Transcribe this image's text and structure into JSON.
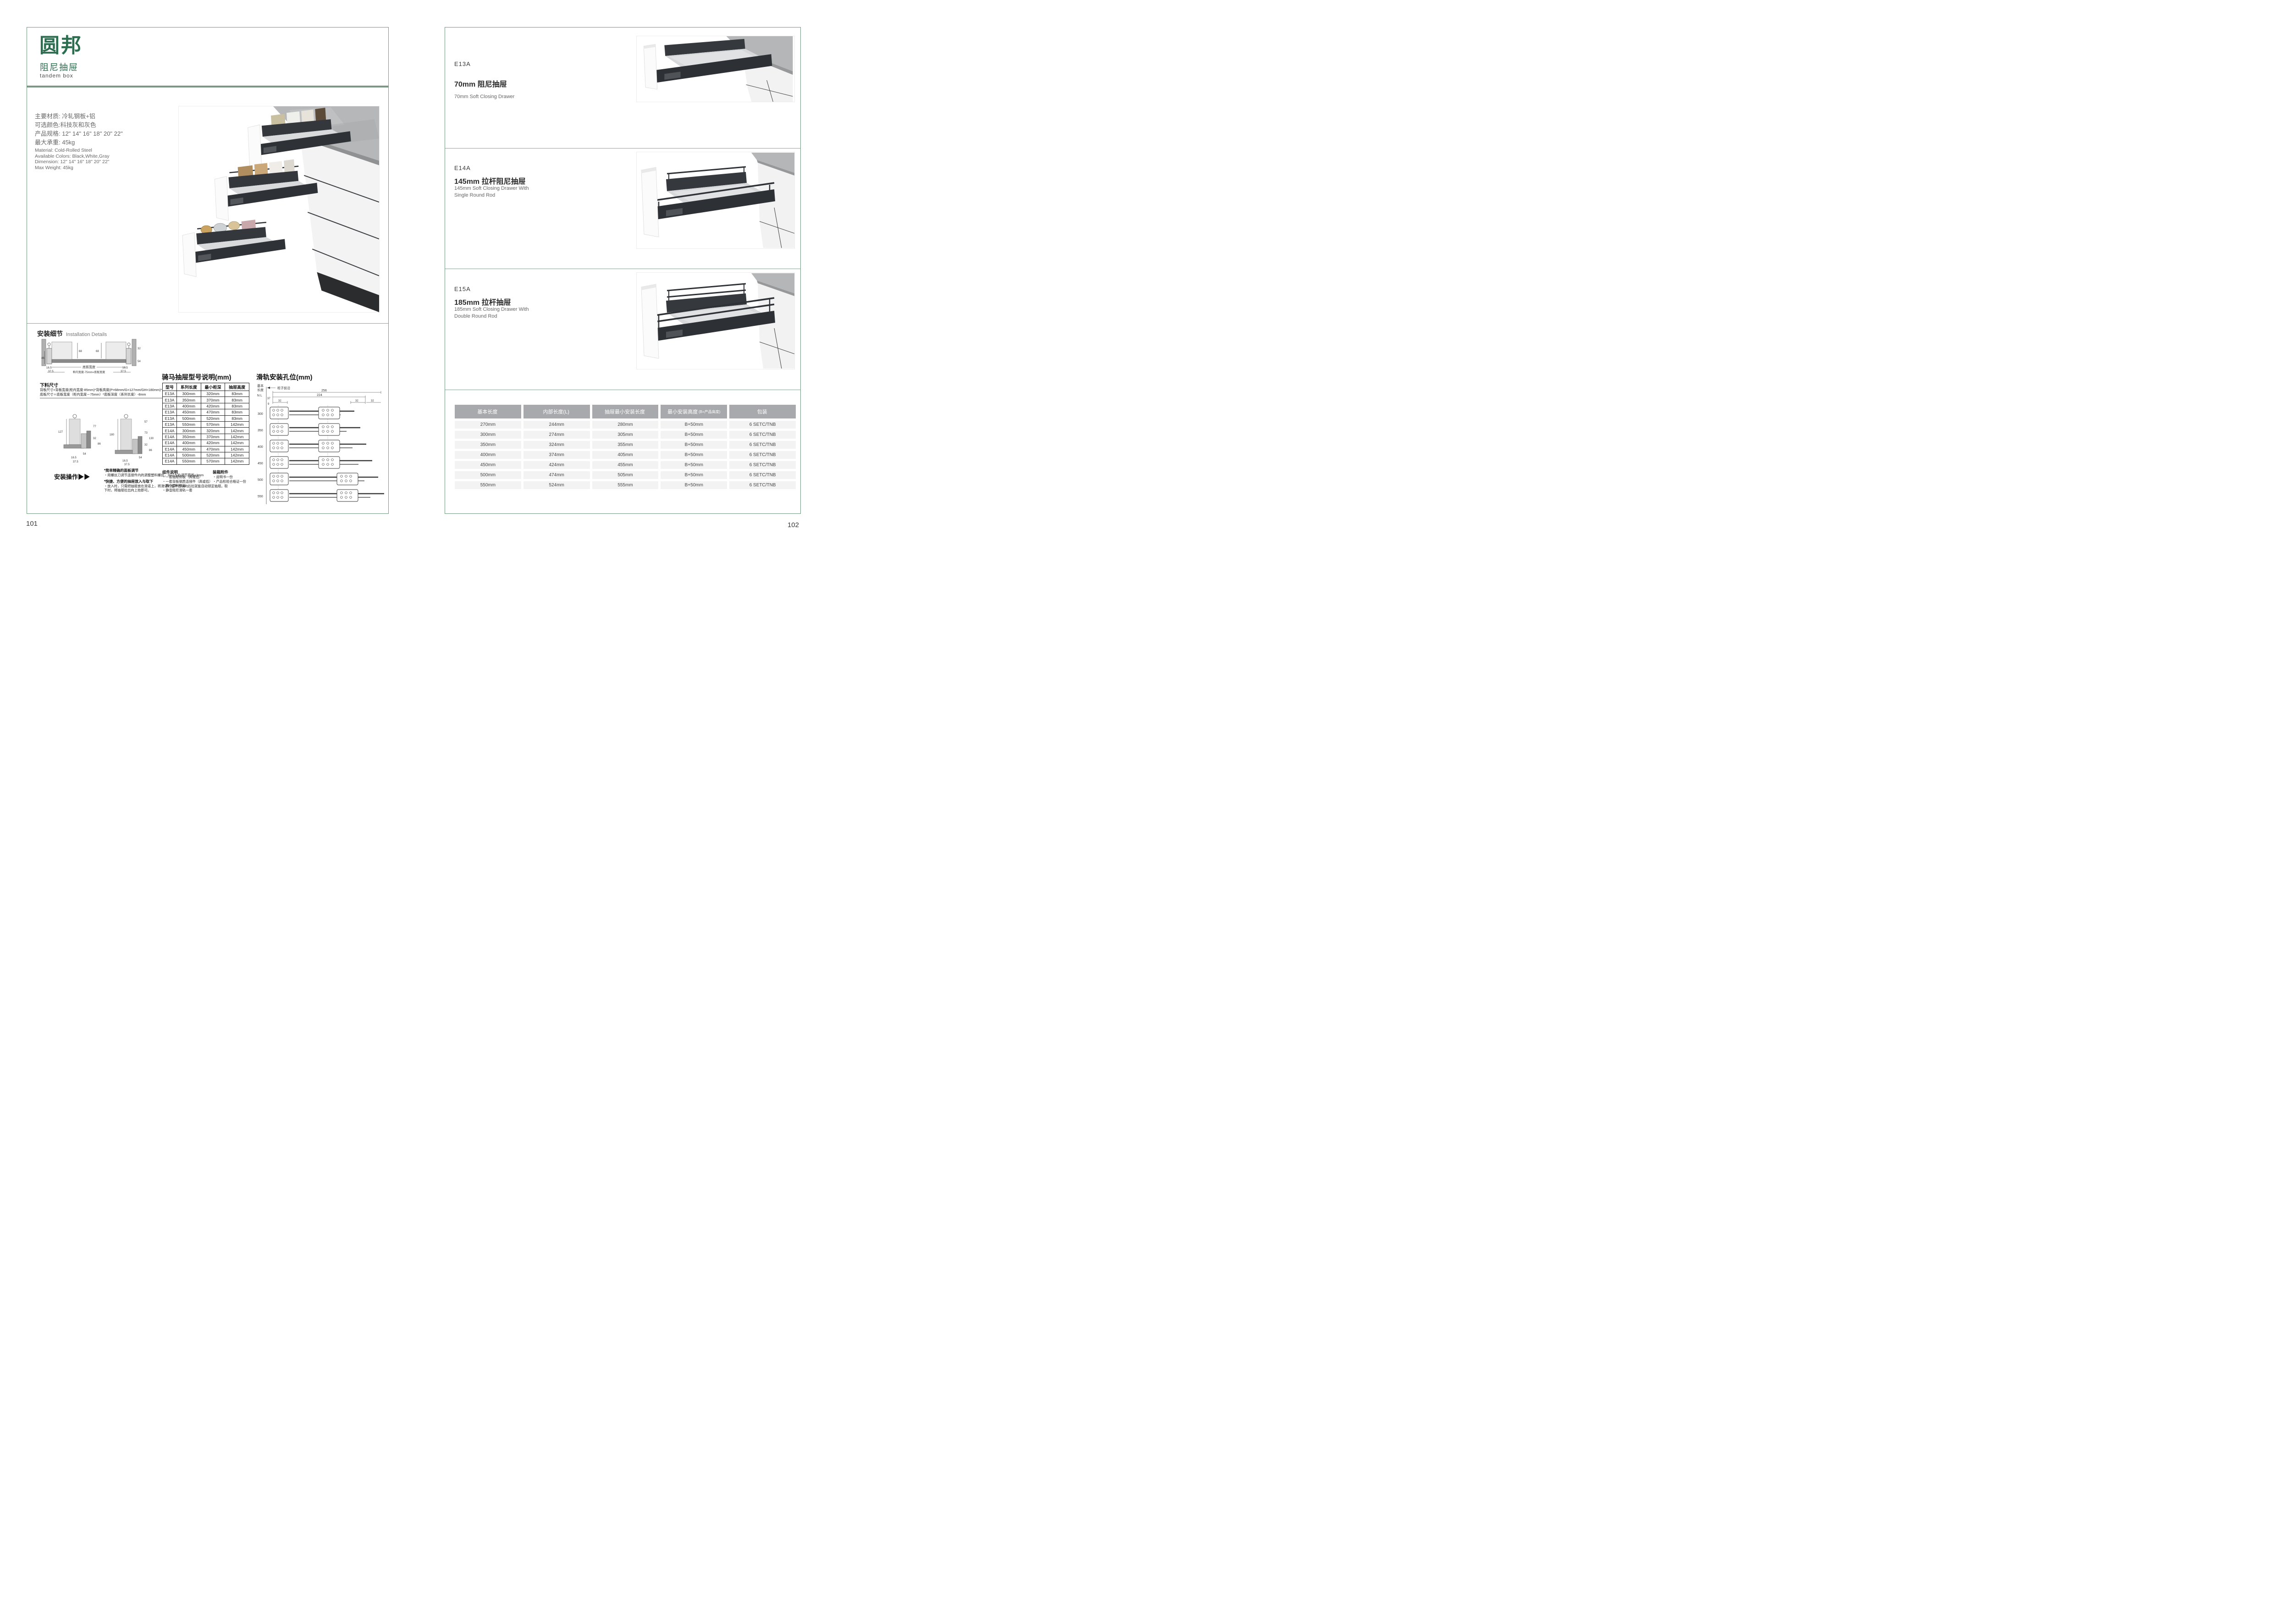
{
  "colors": {
    "brand_green": "#2c6e4f",
    "border_green": "#71977f",
    "divider_green": "#8ca396",
    "table_header_gray": "#a7a9ac",
    "table_row_gray": "#f3f3f4"
  },
  "left_page": {
    "page_number": "101",
    "brand": {
      "logo": "圆邦",
      "subtitle": "阻尼抽屉",
      "tagline": "tandem box"
    },
    "specs_cn": [
      "主要材质: 冷轧钢板+铝",
      "可选颜色:科技灰和灰色",
      "产品规格: 12\" 14\" 16\" 18\" 20\" 22\"",
      "最大承重: 45kg"
    ],
    "specs_en": [
      "Material: Cold-Rolled Steel",
      "Available Colors: Black,White,Gray",
      "Dimension: 12\" 14\" 16\" 18\" 20\" 22\"",
      "Max Weight: 45kg"
    ],
    "install": {
      "title_cn": "安装细节",
      "title_en": "Installation Details",
      "xsec": {
        "d68a": "68",
        "d68b": "68",
        "d46": "46",
        "d32": "32",
        "d54": "54",
        "i165l": "16.5",
        "i375l": "37.5",
        "i165r": "16.5",
        "i375r": "37.5",
        "bw": "底板宽度",
        "fm": "柜内宽度-75mm=底板宽度"
      },
      "cutting": {
        "title": "下料尺寸",
        "line1": "背板尺寸=背板宽度(柜内宽度-85mm)*背板高度(P=68mm/G=127mm/GH=180mm)*16mm",
        "line2": "底板尺寸＝底板宽度（柜内宽度－75mm）*底板深度（系列长度）-8mm"
      },
      "subL": {
        "a": "127",
        "b": "77",
        "c": "32",
        "d": "54",
        "e": "86",
        "f": "16.5",
        "g": "37.5"
      },
      "subR": {
        "a": "180",
        "b": "57",
        "c": "73",
        "d": "130",
        "e": "32",
        "f": "86",
        "g": "54",
        "h": "16.5",
        "i": "37.5"
      },
      "operation": "安装操作▶▶",
      "notes": [
        {
          "head": "*简单精确的面板调节",
          "body": "・用螺丝刀调节连接件内的调整塑料螺丝，可以左右调节面板±3mm"
        },
        {
          "head": "*快捷、方便的抽屉放入与取下",
          "body": "・放入时，只需把抽屉放在滑道上，将滑道的缓冲挡块向后拉就能自动锁定抽屉。取下时，将抽屉拉出向上抬即可。"
        }
      ]
    },
    "model_table": {
      "title": "骑马抽屉型号说明(mm)",
      "headers": [
        "型号",
        "系列长度",
        "最小柜深",
        "抽屉高度"
      ],
      "rows": [
        [
          "E13A",
          "300mm",
          "320mm",
          "83mm"
        ],
        [
          "E13A",
          "350mm",
          "370mm",
          "83mm"
        ],
        [
          "E13A",
          "400mm",
          "420mm",
          "83mm"
        ],
        [
          "E13A",
          "450mm",
          "470mm",
          "83mm"
        ],
        [
          "E13A",
          "500mm",
          "520mm",
          "83mm"
        ],
        [
          "E13A",
          "550mm",
          "570mm",
          "142mm"
        ],
        [
          "E14A",
          "300mm",
          "320mm",
          "142mm"
        ],
        [
          "E14A",
          "350mm",
          "370mm",
          "142mm"
        ],
        [
          "E14A",
          "400mm",
          "420mm",
          "142mm"
        ],
        [
          "E14A",
          "450mm",
          "470mm",
          "142mm"
        ],
        [
          "E14A",
          "500mm",
          "520mm",
          "142mm"
        ],
        [
          "E14A",
          "550mm",
          "570mm",
          "142mm"
        ]
      ]
    },
    "components": {
      "title": "组件说明",
      "items": [
        "・一套抽屉侧板（高或低）",
        "・一套背板钢质连接件（高或低）",
        "・两个塑料侧盖",
        "・静音阻尼滑轨一套"
      ]
    },
    "packing": {
      "title": "装箱附件",
      "items": [
        "・说明书一份",
        "・产品检验合格证一份"
      ]
    },
    "rail": {
      "title": "滑轨安装孔位(mm)",
      "basic1": "基本",
      "basic2": "长度",
      "nl": "N L",
      "front": "柜子前沿",
      "d256": "256",
      "d224": "224",
      "d37": "37",
      "d9": "9",
      "d32a": "32",
      "d32b": "32",
      "d32c": "32",
      "rows": [
        "300",
        "350",
        "400",
        "450",
        "500",
        "550"
      ]
    }
  },
  "right_page": {
    "page_number": "102",
    "products": [
      {
        "model": "E13A",
        "title_cn": "70mm 阻尼抽屉",
        "title_en1": "70mm Soft Closing Drawer",
        "title_en2": ""
      },
      {
        "model": "E14A",
        "title_cn": "145mm 拉杆阻尼抽屉",
        "title_en1": "145mm Soft Closing Drawer With",
        "title_en2": "Single Round Rod"
      },
      {
        "model": "E15A",
        "title_cn": "185mm 拉杆抽屉",
        "title_en1": "185mm Soft Closing Drawer With",
        "title_en2": "Double Round Rod"
      }
    ],
    "size_table": {
      "headers": [
        {
          "t": "基本长度",
          "s": ""
        },
        {
          "t": "内部长度(L)",
          "s": ""
        },
        {
          "t": "抽屉最小安装长度",
          "s": ""
        },
        {
          "t": "最小安装高度",
          "s": "(B=产品高度)"
        },
        {
          "t": "包装",
          "s": ""
        }
      ],
      "rows": [
        [
          "270mm",
          "244mm",
          "280mm",
          "B+50mm",
          "6 SETC/TNB"
        ],
        [
          "300mm",
          "274mm",
          "305mm",
          "B+50mm",
          "6 SETC/TNB"
        ],
        [
          "350mm",
          "324mm",
          "355mm",
          "B+50mm",
          "6 SETC/TNB"
        ],
        [
          "400mm",
          "374mm",
          "405mm",
          "B+50mm",
          "6 SETC/TNB"
        ],
        [
          "450mm",
          "424mm",
          "455mm",
          "B+50mm",
          "6 SETC/TNB"
        ],
        [
          "500mm",
          "474mm",
          "505mm",
          "B+50mm",
          "6 SETC/TNB"
        ],
        [
          "550mm",
          "524mm",
          "555mm",
          "B+50mm",
          "6 SETC/TNB"
        ]
      ]
    }
  }
}
